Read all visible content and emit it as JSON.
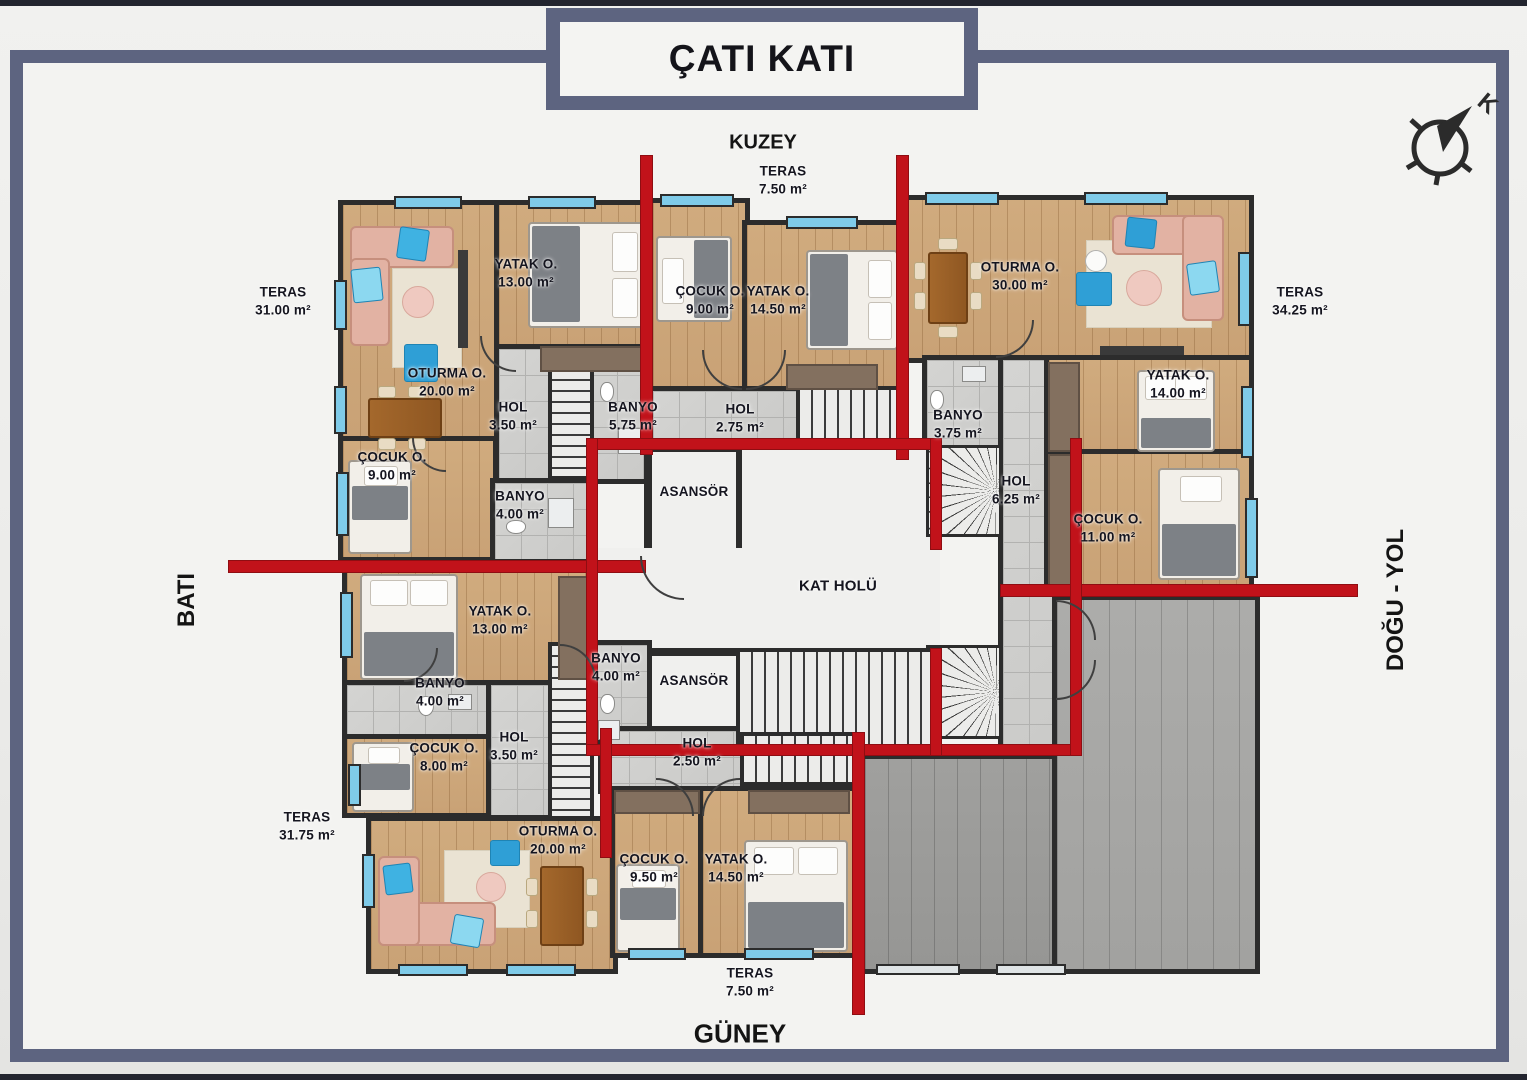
{
  "title": "ÇATI KATI",
  "directions": {
    "north": "KUZEY",
    "south": "GÜNEY",
    "west": "BATI",
    "east": "DOĞU - YOL"
  },
  "compass": {
    "letter": "K"
  },
  "rooms": [
    {
      "label": "TERAS",
      "area": "31.00 m²"
    },
    {
      "label": "TERAS",
      "area": "7.50 m²"
    },
    {
      "label": "TERAS",
      "area": "34.25 m²"
    },
    {
      "label": "TERAS",
      "area": "31.75 m²"
    },
    {
      "label": "TERAS",
      "area": "7.50 m²"
    },
    {
      "label": "YATAK O.",
      "area": "13.00 m²"
    },
    {
      "label": "OTURMA O.",
      "area": "20.00 m²"
    },
    {
      "label": "ÇOCUK O.",
      "area": "9.00 m²"
    },
    {
      "label": "HOL",
      "area": "3.50 m²"
    },
    {
      "label": "BANYO",
      "area": "5.75 m²"
    },
    {
      "label": "BANYO",
      "area": "4.00 m²"
    },
    {
      "label": "ÇOCUK O.",
      "area": "9.00 m²"
    },
    {
      "label": "YATAK O.",
      "area": "14.50 m²"
    },
    {
      "label": "HOL",
      "area": "2.75 m²"
    },
    {
      "label": "OTURMA O.",
      "area": "30.00 m²"
    },
    {
      "label": "BANYO",
      "area": "3.75 m²"
    },
    {
      "label": "HOL",
      "area": "6.25 m²"
    },
    {
      "label": "YATAK O.",
      "area": "14.00 m²"
    },
    {
      "label": "ÇOCUK O.",
      "area": "11.00 m²"
    },
    {
      "label": "ASANSÖR",
      "area": ""
    },
    {
      "label": "KAT HOLÜ",
      "area": ""
    },
    {
      "label": "ASANSÖR",
      "area": ""
    },
    {
      "label": "BANYO",
      "area": "4.00 m²"
    },
    {
      "label": "YATAK O.",
      "area": "13.00 m²"
    },
    {
      "label": "BANYO",
      "area": "4.00 m²"
    },
    {
      "label": "HOL",
      "area": "3.50 m²"
    },
    {
      "label": "ÇOCUK O.",
      "area": "8.00 m²"
    },
    {
      "label": "OTURMA O.",
      "area": "20.00 m²"
    },
    {
      "label": "ÇOCUK O.",
      "area": "9.50 m²"
    },
    {
      "label": "YATAK O.",
      "area": "14.50 m²"
    },
    {
      "label": "HOL",
      "area": "2.50 m²"
    }
  ],
  "colors": {
    "frame": "#5d6480",
    "red_wall": "#c1121a",
    "wall_black": "#2c2c2c",
    "window_blue": "#7fcbe9",
    "wood_floor": "#cda87b",
    "terrace_tile": "#c4c4c2"
  }
}
